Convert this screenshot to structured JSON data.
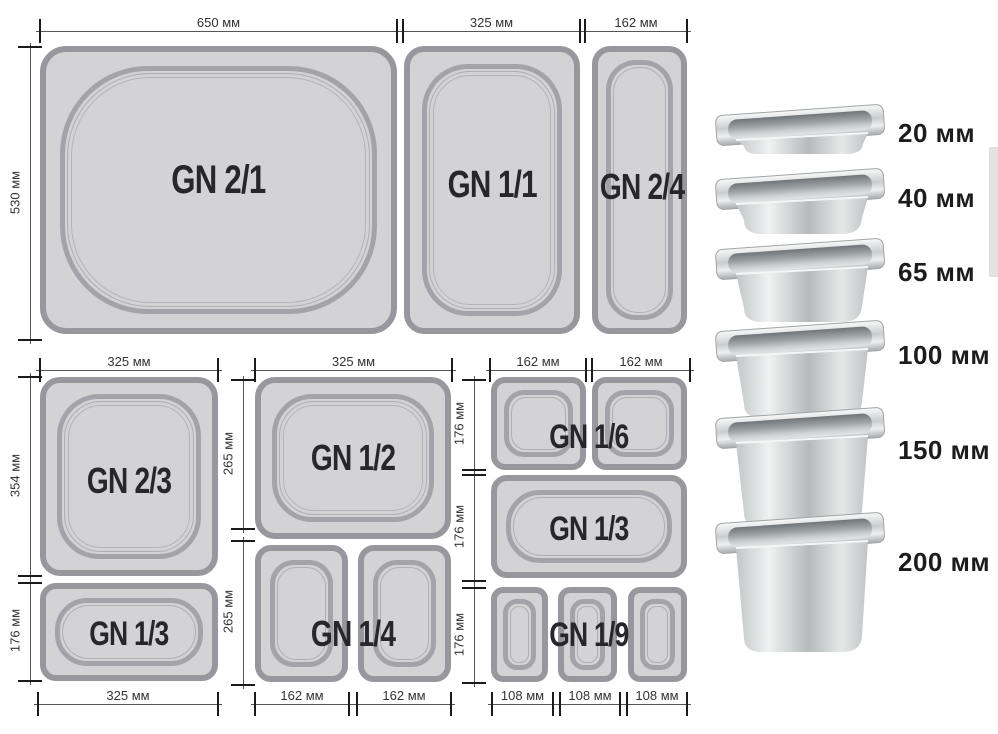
{
  "diagram": {
    "top_section": {
      "pans": {
        "gn_2_1": "GN 2/1",
        "gn_1_1": "GN 1/1",
        "gn_2_4": "GN 2/4"
      },
      "dims": {
        "w650": "650 мм",
        "w325": "325 мм",
        "w162": "162 мм",
        "h530": "530 мм"
      }
    },
    "bottom_left_section": {
      "pans": {
        "gn_2_3": "GN 2/3",
        "gn_1_3": "GN 1/3"
      },
      "dims": {
        "top_w325": "325 мм",
        "h354": "354 мм",
        "h176": "176 мм",
        "bottom_w325": "325 мм"
      }
    },
    "bottom_middle_section": {
      "pans": {
        "gn_1_2": "GN 1/2",
        "gn_1_4": "GN 1/4"
      },
      "dims": {
        "top_w325": "325 мм",
        "h265_upper": "265 мм",
        "h265_lower": "265 мм",
        "bottom_w162_left": "162 мм",
        "bottom_w162_right": "162 мм"
      }
    },
    "bottom_right_section": {
      "pans": {
        "gn_1_6": "GN 1/6",
        "gn_1_3": "GN 1/3",
        "gn_1_9": "GN 1/9"
      },
      "dims": {
        "top_w162_left": "162 мм",
        "top_w162_right": "162 мм",
        "h176_row1": "176 мм",
        "h176_row2": "176 мм",
        "h176_row3": "176 мм",
        "bottom_w108_1": "108 мм",
        "bottom_w108_2": "108 мм",
        "bottom_w108_3": "108 мм"
      }
    }
  },
  "depth_chart": {
    "items": [
      {
        "label": "20 мм"
      },
      {
        "label": "40 мм"
      },
      {
        "label": "65 мм"
      },
      {
        "label": "100 мм"
      },
      {
        "label": "150 мм"
      },
      {
        "label": "200 мм"
      }
    ]
  },
  "colors": {
    "pan_fill": "#d3d3d6",
    "pan_border": "#97979d",
    "ring_border": "#a3a3a9",
    "dim_text": "#333333",
    "gn_label_text": "#26262b",
    "steel_highlight": "#f0f2f2",
    "steel_shadow": "#9ba1a3"
  }
}
